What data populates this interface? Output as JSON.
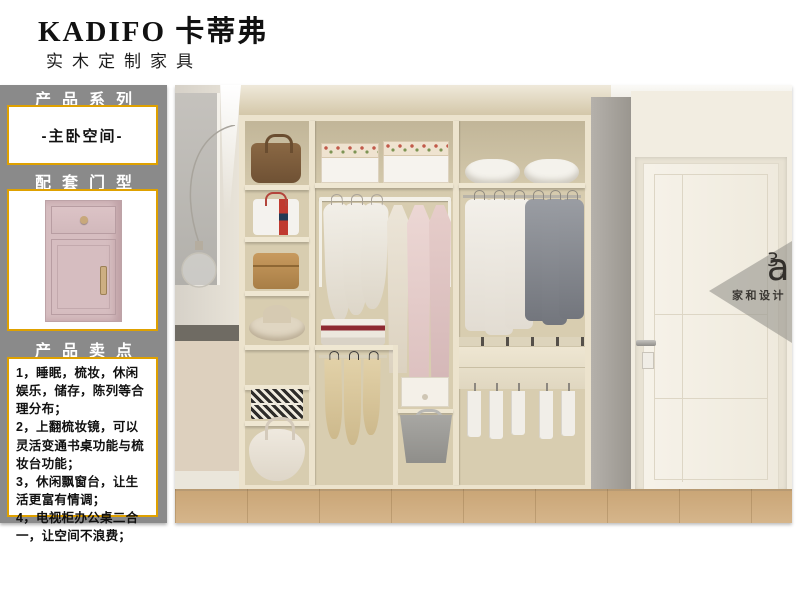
{
  "header": {
    "brand": "KADIFO 卡蒂弗",
    "subtitle": "实木定制家具"
  },
  "sidebar": {
    "series_title": "产品系列",
    "series_value": "-主卧空间-",
    "door_title": "配套门型",
    "selling_title": "产品卖点",
    "selling_points": [
      "1，睡眠，梳妆，休闲娱乐，储存，陈列等合理分布；",
      "2，上翻梳妆镜，可以灵活变通书桌功能与梳妆台功能；",
      "3，休闲飘窗台，让生活更富有情调；",
      "4，电视柜办公桌二合一，让空间不浪费；"
    ]
  },
  "watermark": {
    "logo_base": "a",
    "logo_sup": "3",
    "logo_reg": "®",
    "brand": "家和设计"
  },
  "colors": {
    "sidebar_gray": "#8a8a8a",
    "accent_gold": "#dfa100",
    "door_pink": "#d6bdc0",
    "wardrobe_cream": "#ece3cd",
    "wood_floor": "#caa677"
  }
}
